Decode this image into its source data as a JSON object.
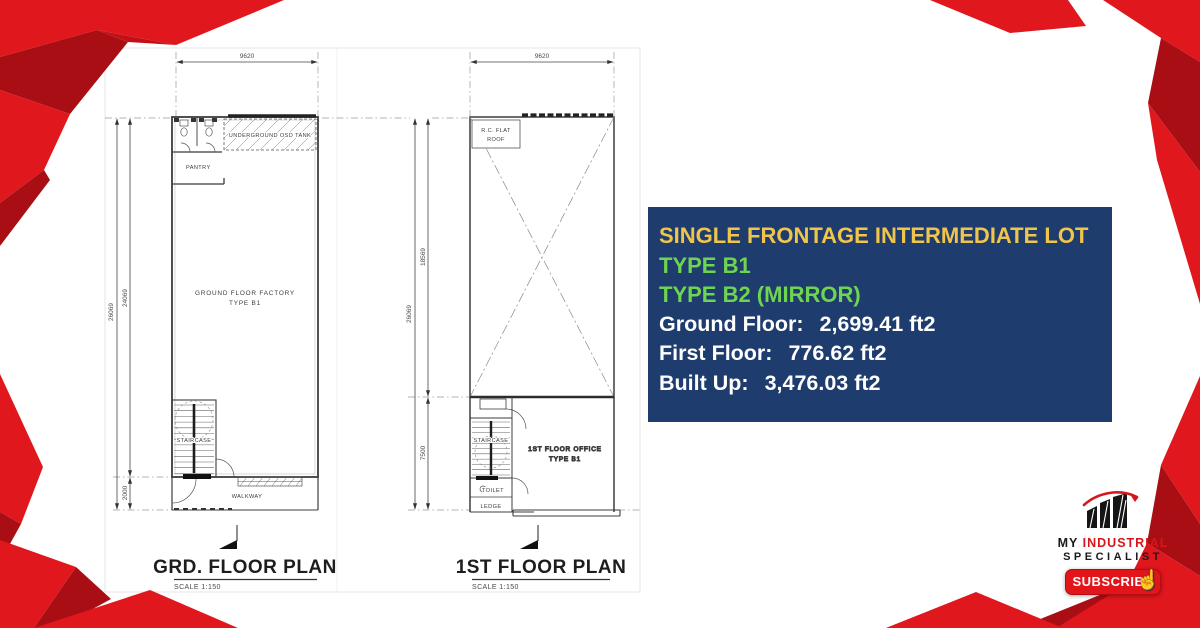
{
  "plans": {
    "grd": {
      "title": "GRD. FLOOR PLAN",
      "scale": "SCALE 1:150",
      "dim_top": "9620",
      "dim_left_outer": "26069",
      "dim_left_inner": "24069",
      "dim_bottom": "2000",
      "labels": {
        "osd_tank": "UNDERGROUND OSD TANK",
        "pantry": "PANTRY",
        "factory_line1": "GROUND FLOOR FACTORY",
        "factory_line2": "TYPE B1",
        "staircase": "STAIRCASE",
        "walkway": "WALKWAY"
      }
    },
    "first": {
      "title": "1ST FLOOR PLAN",
      "scale": "SCALE 1:150",
      "dim_top": "9620",
      "dim_left_outer": "26069",
      "dim_left_upper": "18569",
      "dim_left_lower": "7500",
      "labels": {
        "roof_line1": "R.C. FLAT",
        "roof_line2": "ROOF",
        "staircase": "STAIRCASE",
        "office_line1": "1ST FLOOR OFFICE",
        "office_line2": "TYPE B1",
        "toilet": "TOILET",
        "ledge": "LEDGE"
      }
    }
  },
  "info_box": {
    "title": "SINGLE FRONTAGE INTERMEDIATE LOT",
    "type_line1": "TYPE B1",
    "type_line2": "TYPE B2 (MIRROR)",
    "areas": [
      {
        "label": "Ground Floor:",
        "value": "2,699.41 ft2"
      },
      {
        "label": "First Floor:",
        "value": "776.62 ft2"
      },
      {
        "label": "Built Up:",
        "value": "3,476.03 ft2"
      }
    ],
    "colors": {
      "background": "#1e3c6e",
      "title": "#f0c54b",
      "type": "#6fd550",
      "body": "#ffffff"
    }
  },
  "branding": {
    "logo_my": "MY",
    "logo_industrial": "INDUSTRIAL",
    "logo_specialist": "SPECIALIST",
    "subscribe_label": "SUBSCRIBE",
    "colors": {
      "accent_red": "#e0171d",
      "dark_red": "#a80e13"
    }
  }
}
